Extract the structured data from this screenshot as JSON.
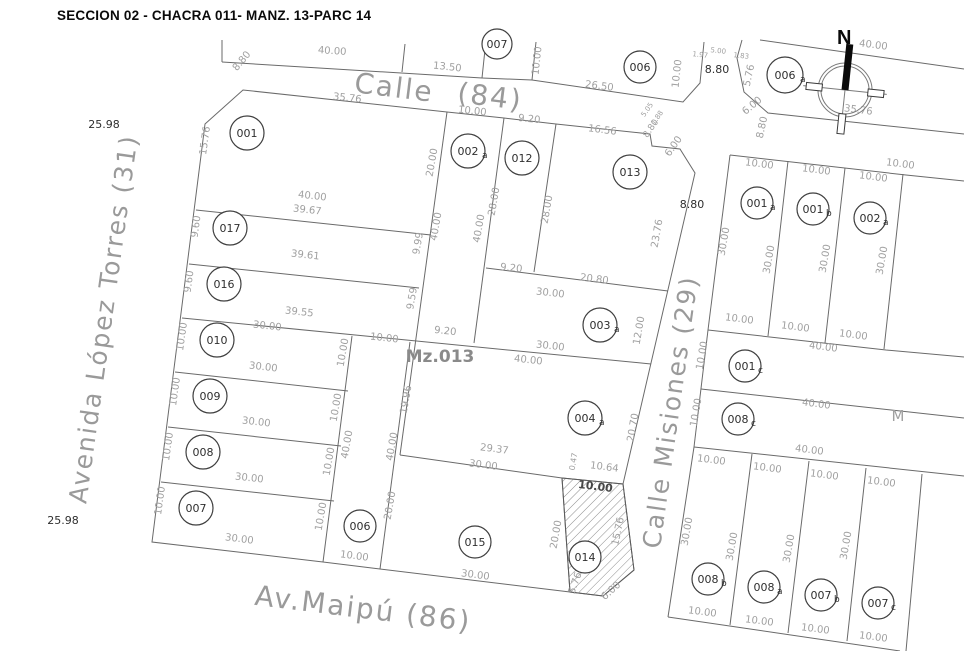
{
  "title": "SECCION 02 - CHACRA 011- MANZ. 13-PARC 14",
  "north_label": "N",
  "block_label": {
    "t": "Mz.013",
    "x": 440,
    "y": 362
  },
  "streets": [
    {
      "t": "Calle",
      "x": 393,
      "y": 97,
      "r": 7,
      "s": 28
    },
    {
      "t": "(84)",
      "x": 489,
      "y": 106,
      "r": 7,
      "s": 28
    },
    {
      "t": "Avenida López Torres (31)",
      "x": 112,
      "y": 320,
      "r": -82,
      "s": 25
    },
    {
      "t": "Calle Misiones (29)",
      "x": 679,
      "y": 413,
      "r": -82,
      "s": 25
    },
    {
      "t": "Av.Maipú (86)",
      "x": 362,
      "y": 618,
      "r": 7,
      "s": 28
    }
  ],
  "parcels": [
    {
      "n": "001",
      "s": "",
      "x": 247,
      "y": 133,
      "r": 17
    },
    {
      "n": "017",
      "s": "",
      "x": 230,
      "y": 228,
      "r": 17
    },
    {
      "n": "016",
      "s": "",
      "x": 224,
      "y": 284,
      "r": 17
    },
    {
      "n": "010",
      "s": "",
      "x": 217,
      "y": 340,
      "r": 17
    },
    {
      "n": "009",
      "s": "",
      "x": 210,
      "y": 396,
      "r": 17
    },
    {
      "n": "008",
      "s": "",
      "x": 203,
      "y": 452,
      "r": 17
    },
    {
      "n": "007",
      "s": "",
      "x": 196,
      "y": 508,
      "r": 17
    },
    {
      "n": "006",
      "s": "",
      "x": 360,
      "y": 526,
      "r": 16
    },
    {
      "n": "015",
      "s": "",
      "x": 475,
      "y": 542,
      "r": 16
    },
    {
      "n": "014",
      "s": "",
      "x": 585,
      "y": 557,
      "r": 16
    },
    {
      "n": "002",
      "s": "a",
      "x": 468,
      "y": 151,
      "r": 17
    },
    {
      "n": "012",
      "s": "",
      "x": 522,
      "y": 158,
      "r": 17
    },
    {
      "n": "013",
      "s": "",
      "x": 630,
      "y": 172,
      "r": 17
    },
    {
      "n": "003",
      "s": "a",
      "x": 600,
      "y": 325,
      "r": 17
    },
    {
      "n": "004",
      "s": "a",
      "x": 585,
      "y": 418,
      "r": 17
    },
    {
      "n": "007",
      "s": "",
      "x": 497,
      "y": 44,
      "r": 15
    },
    {
      "n": "006",
      "s": "",
      "x": 640,
      "y": 67,
      "r": 16
    },
    {
      "n": "006",
      "s": "a",
      "x": 785,
      "y": 75,
      "r": 18
    },
    {
      "n": "001",
      "s": "a",
      "x": 757,
      "y": 203,
      "r": 16
    },
    {
      "n": "001",
      "s": "b",
      "x": 813,
      "y": 209,
      "r": 16
    },
    {
      "n": "002",
      "s": "a",
      "x": 870,
      "y": 218,
      "r": 16
    },
    {
      "n": "001",
      "s": "c",
      "x": 745,
      "y": 366,
      "r": 16
    },
    {
      "n": "008",
      "s": "c",
      "x": 738,
      "y": 419,
      "r": 16
    },
    {
      "n": "008",
      "s": "b",
      "x": 708,
      "y": 579,
      "r": 16
    },
    {
      "n": "008",
      "s": "a",
      "x": 764,
      "y": 587,
      "r": 16
    },
    {
      "n": "007",
      "s": "b",
      "x": 821,
      "y": 595,
      "r": 16
    },
    {
      "n": "007",
      "s": "c",
      "x": 878,
      "y": 603,
      "r": 16
    }
  ],
  "dims": [
    {
      "t": "40.00",
      "x": 332,
      "y": 54,
      "r": 4
    },
    {
      "t": "13.50",
      "x": 447,
      "y": 70,
      "r": 6
    },
    {
      "t": "10.00",
      "x": 540,
      "y": 61,
      "r": -84
    },
    {
      "t": "26.50",
      "x": 599,
      "y": 89,
      "r": 7
    },
    {
      "t": "10.00",
      "x": 680,
      "y": 74,
      "r": -84
    },
    {
      "t": "1.97",
      "x": 700,
      "y": 57,
      "r": 6,
      "s": 7
    },
    {
      "t": "5.00",
      "x": 718,
      "y": 53,
      "r": 6,
      "s": 7
    },
    {
      "t": "1.83",
      "x": 741,
      "y": 58,
      "r": 6,
      "s": 7
    },
    {
      "t": "8.80",
      "x": 717,
      "y": 73,
      "s": 11,
      "c": "dark"
    },
    {
      "t": "40.00",
      "x": 873,
      "y": 48,
      "r": 7
    },
    {
      "t": "5.76",
      "x": 752,
      "y": 76,
      "r": -78
    },
    {
      "t": "6.00",
      "x": 754,
      "y": 108,
      "r": -40
    },
    {
      "t": "8.80",
      "x": 765,
      "y": 128,
      "r": -78
    },
    {
      "t": "35.76",
      "x": 858,
      "y": 113,
      "r": 7
    },
    {
      "t": "8.80",
      "x": 244,
      "y": 63,
      "r": -50
    },
    {
      "t": "25.98",
      "x": 104,
      "y": 128,
      "s": 11,
      "c": "dark"
    },
    {
      "t": "25.98",
      "x": 63,
      "y": 524,
      "s": 11,
      "c": "dark"
    },
    {
      "t": "8.80",
      "x": 692,
      "y": 208,
      "s": 11,
      "c": "dark"
    },
    {
      "t": "35.76",
      "x": 347,
      "y": 101,
      "r": 6
    },
    {
      "t": "10.00",
      "x": 472,
      "y": 114,
      "r": 6
    },
    {
      "t": "9.20",
      "x": 529,
      "y": 122,
      "r": 6
    },
    {
      "t": "16.56",
      "x": 602,
      "y": 133,
      "r": 7
    },
    {
      "t": "5.05",
      "x": 649,
      "y": 111,
      "r": -55,
      "s": 7
    },
    {
      "t": "1.88",
      "x": 659,
      "y": 119,
      "r": -55,
      "s": 7
    },
    {
      "t": "8.80",
      "x": 653,
      "y": 130,
      "r": -55,
      "s": 9
    },
    {
      "t": "6.00",
      "x": 676,
      "y": 148,
      "r": -55
    },
    {
      "t": "15.76",
      "x": 208,
      "y": 141,
      "r": -82
    },
    {
      "t": "9.60",
      "x": 199,
      "y": 227,
      "r": -82
    },
    {
      "t": "9.60",
      "x": 192,
      "y": 282,
      "r": -82
    },
    {
      "t": "10.00",
      "x": 185,
      "y": 337,
      "r": -82
    },
    {
      "t": "10.00",
      "x": 178,
      "y": 392,
      "r": -82
    },
    {
      "t": "10.00",
      "x": 171,
      "y": 447,
      "r": -82
    },
    {
      "t": "10.00",
      "x": 163,
      "y": 501,
      "r": -82
    },
    {
      "t": "40.00",
      "x": 312,
      "y": 199,
      "r": 6
    },
    {
      "t": "39.67",
      "x": 307,
      "y": 213,
      "r": 6
    },
    {
      "t": "39.61",
      "x": 305,
      "y": 258,
      "r": 6
    },
    {
      "t": "39.55",
      "x": 299,
      "y": 315,
      "r": 6
    },
    {
      "t": "30.00",
      "x": 267,
      "y": 329,
      "r": 6
    },
    {
      "t": "30.00",
      "x": 263,
      "y": 370,
      "r": 6
    },
    {
      "t": "30.00",
      "x": 256,
      "y": 425,
      "r": 6
    },
    {
      "t": "30.00",
      "x": 249,
      "y": 481,
      "r": 6
    },
    {
      "t": "30.00",
      "x": 239,
      "y": 542,
      "r": 7
    },
    {
      "t": "10.00",
      "x": 346,
      "y": 353,
      "r": -80
    },
    {
      "t": "10.00",
      "x": 339,
      "y": 408,
      "r": -80
    },
    {
      "t": "10.00",
      "x": 332,
      "y": 462,
      "r": -80
    },
    {
      "t": "10.00",
      "x": 324,
      "y": 517,
      "r": -80
    },
    {
      "t": "20.00",
      "x": 435,
      "y": 163,
      "r": -80
    },
    {
      "t": "40.00",
      "x": 439,
      "y": 227,
      "r": -80
    },
    {
      "t": "40.00",
      "x": 482,
      "y": 229,
      "r": -80
    },
    {
      "t": "19.96",
      "x": 409,
      "y": 400,
      "r": -80
    },
    {
      "t": "28.00",
      "x": 497,
      "y": 202,
      "r": -80
    },
    {
      "t": "28.00",
      "x": 550,
      "y": 210,
      "r": -80
    },
    {
      "t": "9.99",
      "x": 421,
      "y": 244,
      "r": -80
    },
    {
      "t": "9.59",
      "x": 415,
      "y": 299,
      "r": -80
    },
    {
      "t": "9.20",
      "x": 511,
      "y": 271,
      "r": 6
    },
    {
      "t": "20.80",
      "x": 594,
      "y": 282,
      "r": 7
    },
    {
      "t": "30.00",
      "x": 550,
      "y": 296,
      "r": 6
    },
    {
      "t": "9.20",
      "x": 445,
      "y": 334,
      "r": 6
    },
    {
      "t": "30.00",
      "x": 550,
      "y": 349,
      "r": 6
    },
    {
      "t": "40.00",
      "x": 528,
      "y": 363,
      "r": 6
    },
    {
      "t": "23.76",
      "x": 660,
      "y": 234,
      "r": -80
    },
    {
      "t": "12.00",
      "x": 642,
      "y": 331,
      "r": -80
    },
    {
      "t": "20.70",
      "x": 636,
      "y": 428,
      "r": -80
    },
    {
      "t": "0.47",
      "x": 576,
      "y": 462,
      "r": -80,
      "s": 8
    },
    {
      "t": "10.64",
      "x": 604,
      "y": 470,
      "r": 7
    },
    {
      "t": "29.37",
      "x": 494,
      "y": 452,
      "r": 7
    },
    {
      "t": "30.00",
      "x": 483,
      "y": 468,
      "r": 7
    },
    {
      "t": "10.00",
      "x": 384,
      "y": 341,
      "r": 6
    },
    {
      "t": "40.00",
      "x": 350,
      "y": 445,
      "r": -80
    },
    {
      "t": "40.00",
      "x": 395,
      "y": 447,
      "r": -80
    },
    {
      "t": "20.00",
      "x": 393,
      "y": 506,
      "r": -80
    },
    {
      "t": "10.00",
      "x": 354,
      "y": 559,
      "r": 7
    },
    {
      "t": "30.00",
      "x": 475,
      "y": 578,
      "r": 7
    },
    {
      "t": "10.00",
      "x": 595,
      "y": 490,
      "r": 7,
      "s": 11,
      "c": "bold"
    },
    {
      "t": "20.00",
      "x": 559,
      "y": 535,
      "r": -80
    },
    {
      "t": "15.76",
      "x": 621,
      "y": 532,
      "r": -78
    },
    {
      "t": "5.76",
      "x": 578,
      "y": 584,
      "r": -70
    },
    {
      "t": "6.00",
      "x": 613,
      "y": 593,
      "r": -42
    },
    {
      "t": "10.00",
      "x": 759,
      "y": 167,
      "r": 7
    },
    {
      "t": "10.00",
      "x": 816,
      "y": 173,
      "r": 7
    },
    {
      "t": "10.00",
      "x": 873,
      "y": 180,
      "r": 7
    },
    {
      "t": "10.00",
      "x": 900,
      "y": 167,
      "r": 7
    },
    {
      "t": "30.00",
      "x": 727,
      "y": 242,
      "r": -80
    },
    {
      "t": "30.00",
      "x": 772,
      "y": 260,
      "r": -80
    },
    {
      "t": "30.00",
      "x": 828,
      "y": 259,
      "r": -80
    },
    {
      "t": "30.00",
      "x": 885,
      "y": 261,
      "r": -80
    },
    {
      "t": "10.00",
      "x": 739,
      "y": 322,
      "r": 7
    },
    {
      "t": "10.00",
      "x": 795,
      "y": 330,
      "r": 7
    },
    {
      "t": "10.00",
      "x": 853,
      "y": 338,
      "r": 7
    },
    {
      "t": "40.00",
      "x": 823,
      "y": 350,
      "r": 7
    },
    {
      "t": "10.00",
      "x": 705,
      "y": 356,
      "r": -80
    },
    {
      "t": "40.00",
      "x": 816,
      "y": 407,
      "r": 7
    },
    {
      "t": "10.00",
      "x": 699,
      "y": 413,
      "r": -80
    },
    {
      "t": "40.00",
      "x": 809,
      "y": 453,
      "r": 7
    },
    {
      "t": "10.00",
      "x": 711,
      "y": 463,
      "r": 7
    },
    {
      "t": "10.00",
      "x": 767,
      "y": 471,
      "r": 7
    },
    {
      "t": "10.00",
      "x": 824,
      "y": 478,
      "r": 7
    },
    {
      "t": "10.00",
      "x": 881,
      "y": 485,
      "r": 7
    },
    {
      "t": "30.00",
      "x": 690,
      "y": 532,
      "r": -80
    },
    {
      "t": "30.00",
      "x": 735,
      "y": 547,
      "r": -80
    },
    {
      "t": "30.00",
      "x": 792,
      "y": 549,
      "r": -80
    },
    {
      "t": "30.00",
      "x": 849,
      "y": 546,
      "r": -80
    },
    {
      "t": "10.00",
      "x": 702,
      "y": 615,
      "r": 7
    },
    {
      "t": "10.00",
      "x": 759,
      "y": 624,
      "r": 7
    },
    {
      "t": "10.00",
      "x": 815,
      "y": 632,
      "r": 7
    },
    {
      "t": "10.00",
      "x": 873,
      "y": 640,
      "r": 7
    },
    {
      "t": "M",
      "x": 898,
      "y": 421,
      "s": 15
    }
  ],
  "geometry": {
    "paths": [
      "M205,124 L243,90 L447,112 L504,118 L556,124 L650,134 L652,146 L680,149 L695,173 L623,484 L634,570 L603,596 L570,592 L380,569 L323,562 L152,542 Z",
      "M196,210 L431,235",
      "M189,264 L419,288",
      "M182,318 L651,364",
      "M175,372 L348,391",
      "M168,427 L341,446",
      "M161,482 L334,501",
      "M447,112 L400,455",
      "M504,118 L474,343",
      "M556,124 L534,272",
      "M486,268 L668,291",
      "M352,336 L323,562",
      "M410,342 L380,569",
      "M400,455 L562,478",
      "M562,478 L570,592",
      "M562,478 L623,484",
      "M222,62 L482,78 L532,80 L683,102 L700,83 L704,42",
      "M222,40 L222,62",
      "M405,44 L402,72",
      "M486,40 L482,78",
      "M536,42 L532,80",
      "M742,40 L737,58 L744,92 L768,113 L964,134",
      "M760,40 L964,69",
      "M730,155 L906,175 L964,181",
      "M730,155 L708,330",
      "M788,161 L768,336",
      "M845,168 L825,343",
      "M903,174 L884,349",
      "M708,330 L886,350 L964,357",
      "M708,330 L694,447",
      "M701,389 L964,418",
      "M694,447 L964,476",
      "M694,447 L668,617",
      "M752,454 L730,625",
      "M809,461 L788,633",
      "M866,468 L847,641",
      "M922,474 L906,651",
      "M668,617 L900,651"
    ],
    "hatch_parcel": "562,478 623,484 634,570 603,596 570,592"
  }
}
